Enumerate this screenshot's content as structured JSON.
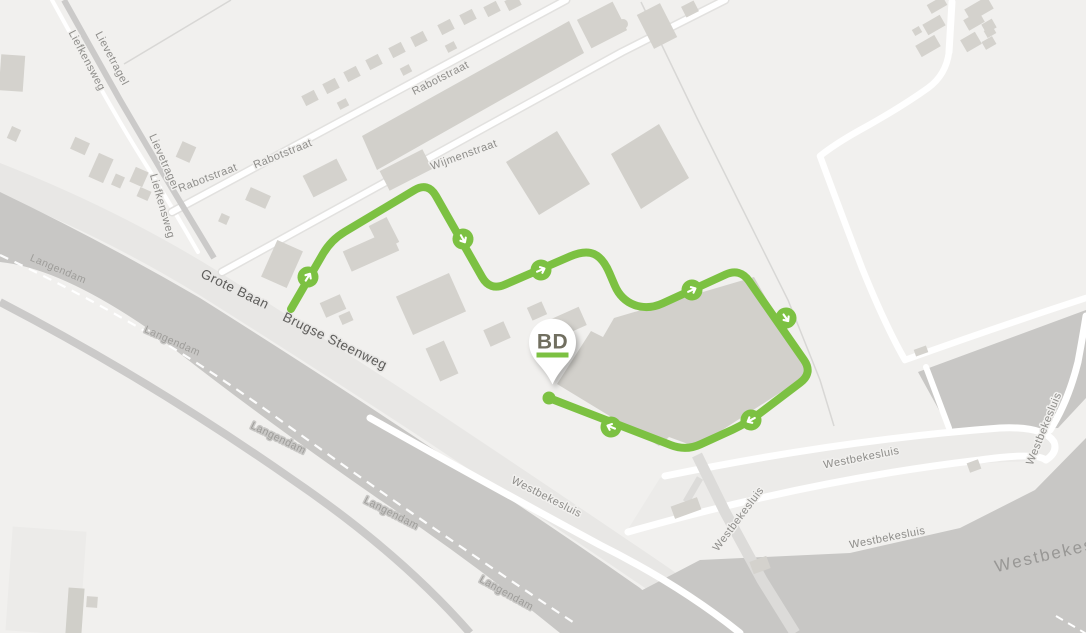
{
  "map": {
    "background_color": "#f1f0ee",
    "palette": {
      "route_green": "#7cc142",
      "water_gray": "#c8c7c5",
      "building_gray": "#d4d2cd",
      "road_white": "#ffffff",
      "corridor_gray": "#e8e7e5",
      "major_label": "#5e5d5b",
      "minor_label": "#8e8d8a"
    },
    "street_labels": [
      {
        "text": "Liefkensweg",
        "x": 84,
        "y": 62,
        "rot": 62,
        "kind": "minor"
      },
      {
        "text": "Lievetragel",
        "x": 109,
        "y": 60,
        "rot": 62,
        "kind": "minor"
      },
      {
        "text": "Lievetragel",
        "x": 161,
        "y": 163,
        "rot": 66,
        "kind": "minor"
      },
      {
        "text": "Liefkensweg",
        "x": 159,
        "y": 207,
        "rot": 74,
        "kind": "minor"
      },
      {
        "text": "Rabotstraat",
        "x": 209,
        "y": 181,
        "rot": -21,
        "kind": "minor"
      },
      {
        "text": "Rabotstraat",
        "x": 284,
        "y": 157,
        "rot": -22,
        "kind": "minor"
      },
      {
        "text": "Rabotstraat",
        "x": 442,
        "y": 81,
        "rot": -27,
        "kind": "minor"
      },
      {
        "text": "Wijmenstraat",
        "x": 465,
        "y": 158,
        "rot": -20,
        "kind": "minor"
      },
      {
        "text": "Grote Baan",
        "x": 233,
        "y": 293,
        "rot": 26,
        "kind": "major"
      },
      {
        "text": "Brugse Steenweg",
        "x": 333,
        "y": 345,
        "rot": 26,
        "kind": "major"
      },
      {
        "text": "Langendam",
        "x": 57,
        "y": 272,
        "rot": 23,
        "kind": "canal"
      },
      {
        "text": "Langendam",
        "x": 171,
        "y": 344,
        "rot": 24,
        "kind": "canal"
      },
      {
        "text": "Langendam",
        "x": 277,
        "y": 441,
        "rot": 26,
        "kind": "canal"
      },
      {
        "text": "Langendam",
        "x": 390,
        "y": 516,
        "rot": 27,
        "kind": "canal"
      },
      {
        "text": "Langendam",
        "x": 505,
        "y": 596,
        "rot": 29,
        "kind": "canal"
      },
      {
        "text": "Westbekesluis",
        "x": 545,
        "y": 500,
        "rot": 27,
        "kind": "minor"
      },
      {
        "text": "Westbekesluis",
        "x": 862,
        "y": 461,
        "rot": -11,
        "kind": "minor"
      },
      {
        "text": "Westbekesluis",
        "x": 888,
        "y": 541,
        "rot": -11,
        "kind": "minor"
      },
      {
        "text": "Westbekesluis",
        "x": 741,
        "y": 521,
        "rot": -53,
        "kind": "minor"
      },
      {
        "text": "Westbekesluis",
        "x": 1047,
        "y": 430,
        "rot": -68,
        "kind": "minor"
      },
      {
        "text": "Westbekesluis",
        "x": 1062,
        "y": 557,
        "rot": -13,
        "kind": "big"
      }
    ],
    "route": {
      "color": "#7cc142",
      "stroke_width": 8,
      "corner_radius": 16,
      "points": [
        [
          291,
          309
        ],
        [
          331,
          240
        ],
        [
          428,
          182
        ],
        [
          490,
          291
        ],
        [
          585,
          250
        ],
        [
          603,
          258
        ],
        [
          621,
          300
        ],
        [
          648,
          310
        ],
        [
          740,
          268
        ],
        [
          813,
          373
        ],
        [
          747,
          423
        ],
        [
          686,
          451
        ],
        [
          549,
          398
        ]
      ],
      "marker_icon": "direction-arrow-icon",
      "marker_radius": 10.5,
      "markers": [
        {
          "x": 308,
          "y": 277,
          "angle": -58
        },
        {
          "x": 463,
          "y": 239,
          "angle": 60
        },
        {
          "x": 541,
          "y": 270,
          "angle": -23
        },
        {
          "x": 692,
          "y": 290,
          "angle": -25
        },
        {
          "x": 786,
          "y": 318,
          "angle": 55
        },
        {
          "x": 751,
          "y": 420,
          "angle": 152
        },
        {
          "x": 611,
          "y": 427,
          "angle": 202
        }
      ],
      "end_dot": {
        "x": 549,
        "y": 398,
        "radius": 6.5
      }
    },
    "pin": {
      "label": "BD",
      "label_color": "#716f60",
      "underline_color": "#7cc142",
      "fill": "#ffffff",
      "cx": 552.5,
      "cy": 342,
      "tip_y": 384.5
    }
  }
}
